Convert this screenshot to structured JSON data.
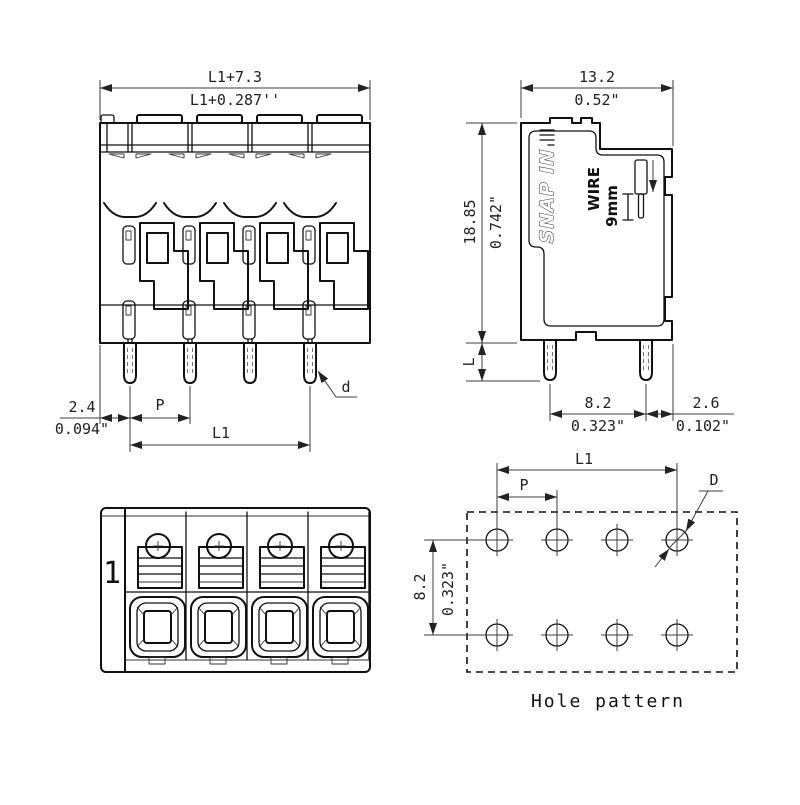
{
  "front_view": {
    "total_width_mm": "L1+7.3",
    "total_width_in": "L1+0.287''",
    "edge_to_pin_mm": "2.4",
    "edge_to_pin_in": "0.094\"",
    "pitch_label": "P",
    "length_label": "L1",
    "pin_dia_label": "d"
  },
  "side_view": {
    "depth_mm": "13.2",
    "depth_in": "0.52\"",
    "height_mm": "18.85",
    "height_in": "0.742\"",
    "pin_length_label": "L",
    "pin_row_mm": "8.2",
    "pin_row_in": "0.323\"",
    "pin_to_edge_mm": "2.6",
    "pin_to_edge_in": "0.102\"",
    "snap_in_marking": "SNAP IN",
    "wire_marking": "WIRE",
    "wire_length_marking": "9mm"
  },
  "top_view": {
    "position_marking": "1"
  },
  "hole_pattern": {
    "caption": "Hole pattern",
    "length_label": "L1",
    "pitch_label": "P",
    "hole_dia_label": "D",
    "row_spacing_mm": "8.2",
    "row_spacing_in": "0.323\""
  },
  "colors": {
    "line": "#111111",
    "dimension": "#3c3c3c",
    "background": "#ffffff"
  }
}
